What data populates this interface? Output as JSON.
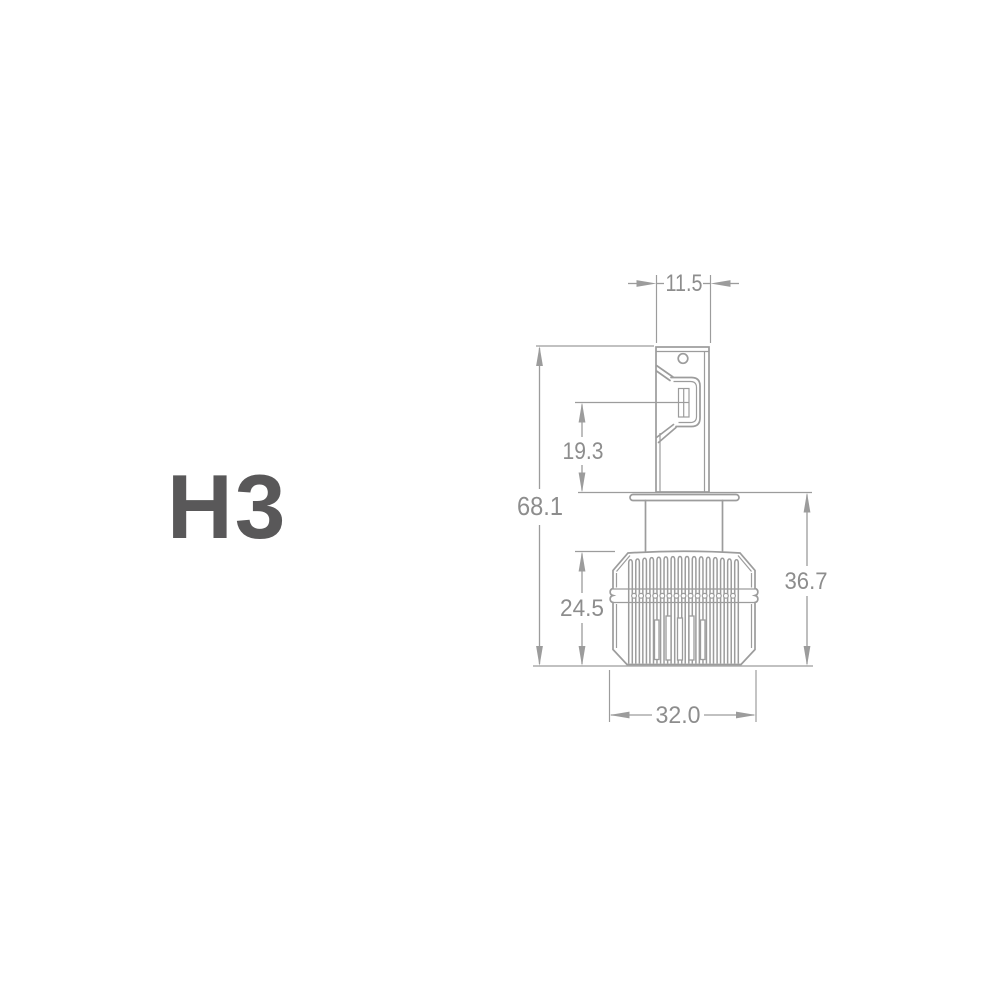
{
  "title": {
    "text": "H3"
  },
  "colors": {
    "background": "#ffffff",
    "title": "#595859",
    "drawing_line": "#9c9c9c",
    "dimension_text": "#8d8d8d"
  },
  "drawing": {
    "type": "technical-dimension-diagram",
    "subject": "H3 LED headlight bulb side view",
    "dimensions": {
      "tab_width": "11.5",
      "electrode_to_flange": "19.3",
      "overall_height": "68.1",
      "heatsink_height": "24.5",
      "flange_to_base": "36.7",
      "heatsink_width": "32.0"
    }
  }
}
